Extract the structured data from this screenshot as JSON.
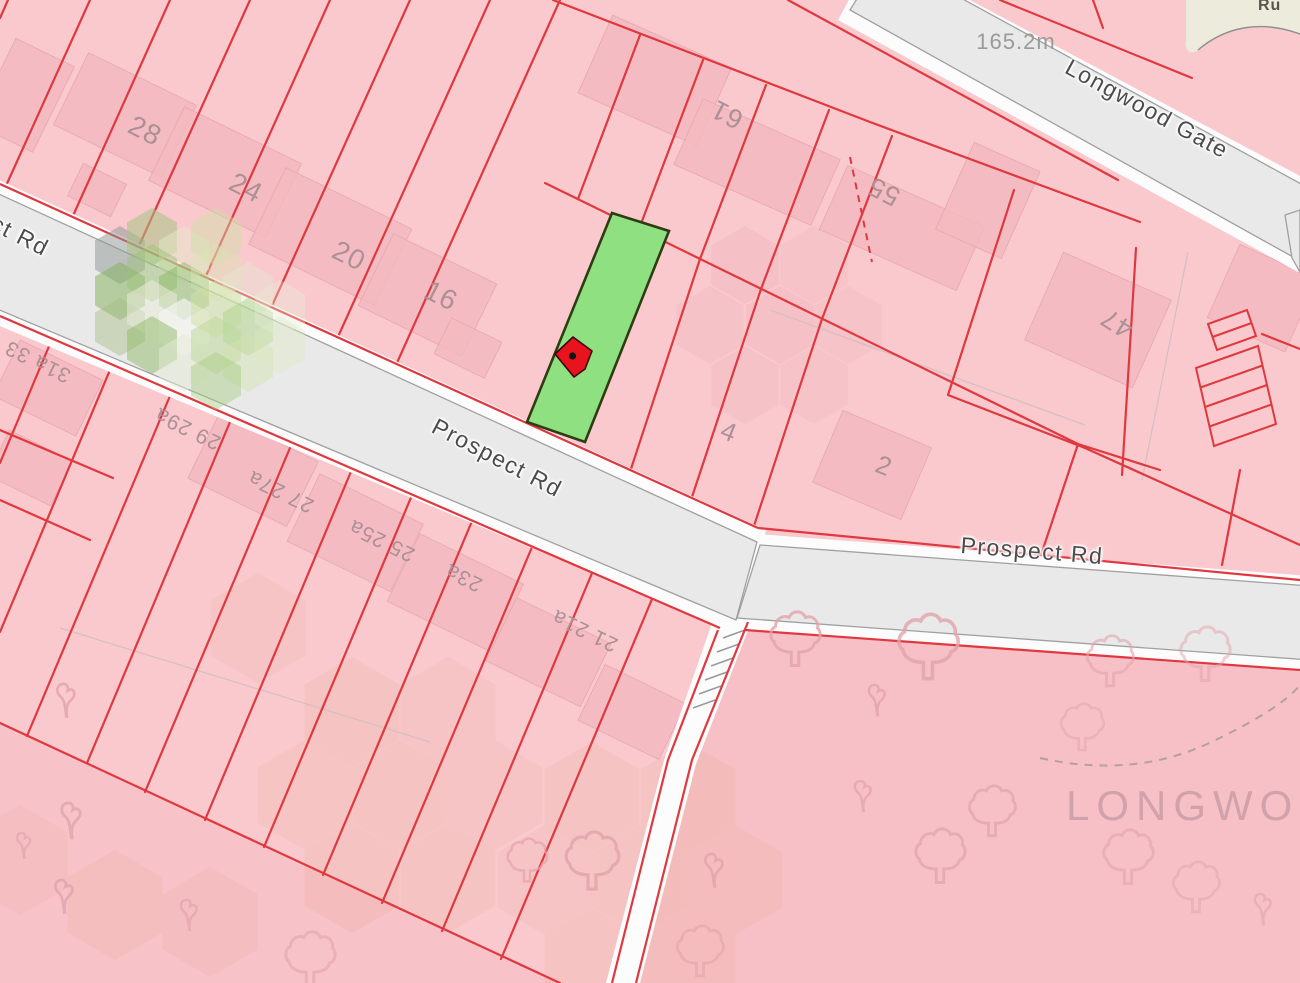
{
  "map": {
    "type": "cadastral-parcel-map",
    "labels": {
      "prospect_west": "Prospect Rd",
      "prospect_west_partial": "ct Rd",
      "prospect_east": "Prospect Rd",
      "longwood_gate": "Longwood Gate",
      "top_right_partial": "Ru",
      "distance": "165.2m",
      "area": "LONGWOOD",
      "n28": "28",
      "n24": "24",
      "n20": "20",
      "n16": "16",
      "n61": "61",
      "n55": "55",
      "n47": "47",
      "n31a_33": "31a 33",
      "n29_29a": "29 29a",
      "n27_27a": "27 27a",
      "n25_25a": "25 25a",
      "n23a": "23a",
      "n21_21a": "21 21a",
      "n4": "4",
      "n2": "2"
    },
    "highlight_parcel": {
      "status": "selected",
      "fill": "#8fe081"
    },
    "marker": {
      "type": "red-location-pin",
      "fill": "#e8131c"
    },
    "colors": {
      "parcel_fill": "#f9c9ce",
      "parcel_boundary": "#e0383f",
      "building_fill": "#f3b9bf",
      "road_fill": "#e9e9e9",
      "road_casing": "#a0a0a0",
      "highlight_border": "#2e3c13",
      "area_text": "#cb9da7",
      "number_text": "#ab9096",
      "open_land": "#ecebdc"
    }
  }
}
